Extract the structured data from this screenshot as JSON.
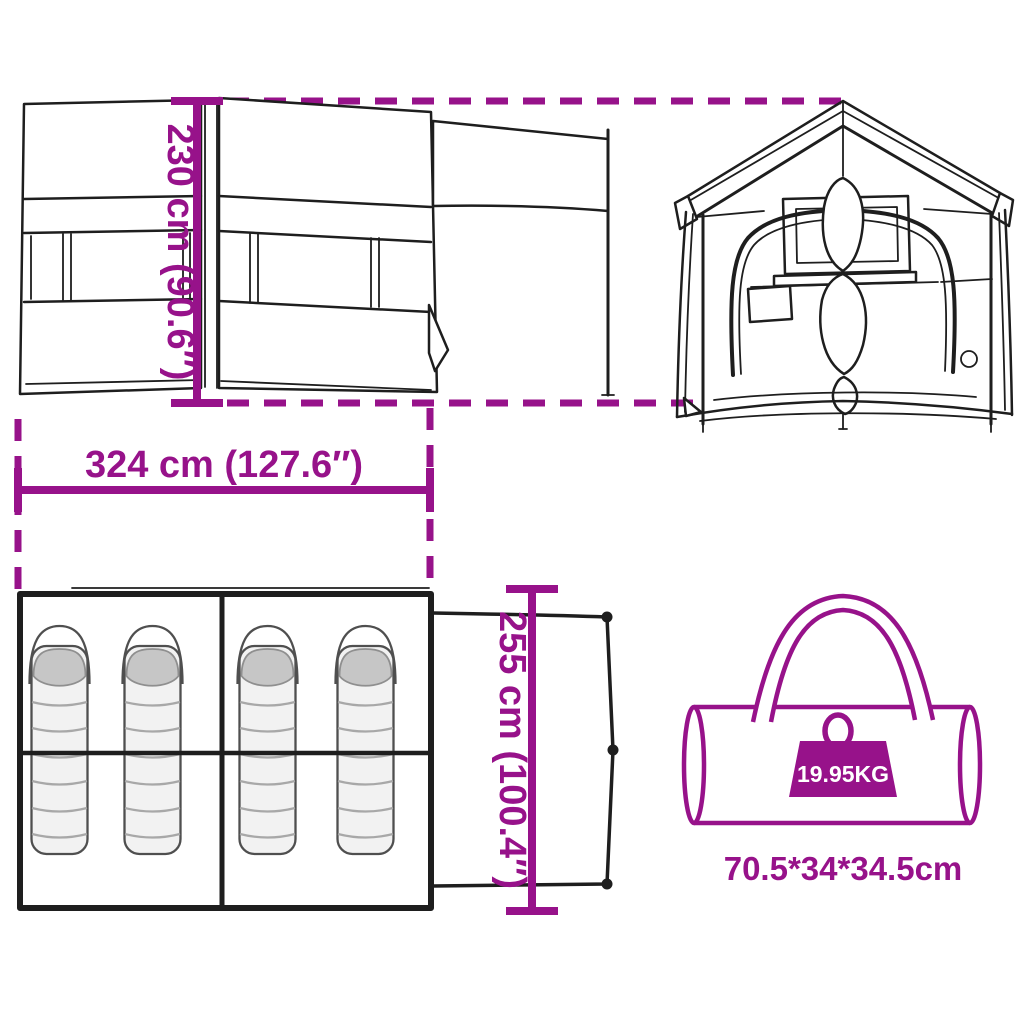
{
  "page": {
    "background_color": "#ffffff",
    "accent_color": "#97128A",
    "line_color": "#1e1e1e"
  },
  "dimensions": {
    "height_label": "230 cm (90.6″)",
    "width_label": "324 cm (127.6″)",
    "depth_label": "255 cm (100.4″)"
  },
  "package": {
    "weight_label": "19.95KG",
    "size_label": "70.5*34*34.5cm"
  },
  "figures": {
    "side_view_icon": "tent-side-view",
    "front_view_icon": "tent-front-view",
    "floor_plan_icon": "tent-floor-plan",
    "sleeping_bag_icon": "sleeping-bag",
    "sleeping_bag_count": 4,
    "carry_bag_icon": "carry-bag",
    "weight_icon": "weight"
  }
}
